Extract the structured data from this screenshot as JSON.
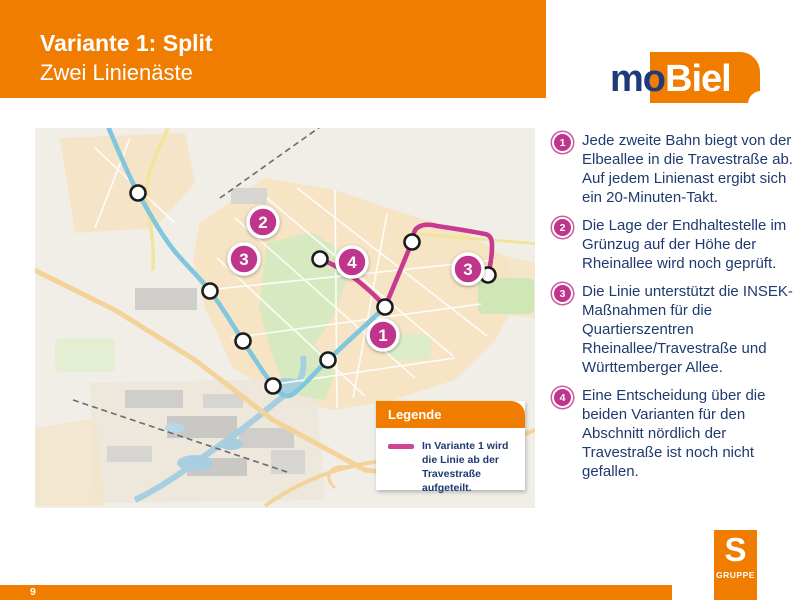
{
  "header": {
    "title": "Variante 1: Split",
    "subtitle": "Zwei Linienäste"
  },
  "mobiel_logo": {
    "mo": "mo",
    "biel": "Biel"
  },
  "notes": [
    {
      "num": "1",
      "text": "Jede zweite Bahn biegt von der Elbeallee in die Travestraße ab. Auf jedem Linienast ergibt sich ein 20-Minuten-Takt."
    },
    {
      "num": "2",
      "text": "Die Lage der Endhaltestelle im Grünzug auf der Höhe der Rheinallee wird noch geprüft."
    },
    {
      "num": "3",
      "text": "Die Linie unterstützt die INSEK-Maßnahmen für die Quartierszentren Rheinallee/Travestraße und Württemberger Allee."
    },
    {
      "num": "4",
      "text": "Eine Entscheidung über die beiden Varianten für den Abschnitt nördlich der Travestraße ist noch nicht gefallen."
    }
  ],
  "legend": {
    "title": "Legende",
    "entry": "In Variante 1 wird die Linie ab der Travestraße aufgeteilt."
  },
  "map": {
    "routes": {
      "blue": "M72,-4 C83,22 94,49 103,65 C116,88 129,111 142,126 C153,139 164,149 175,163 C188,180 197,196 208,213 C217,227 228,244 236,255 C242,263 250,272 258,266 C270,257 280,244 293,232 C311,215 332,196 350,179",
      "pink_west": "M285,131 C298,136 312,144 323,153 C334,162 344,171 350,179",
      "pink_loop": "M350,179 C357,162 368,136 377,114 C379,108 378,103 382,100 C387,96 394,96 402,98 C422,101 440,104 450,106 C456,107 457,112 457,118 C457,129 455,139 453,147"
    },
    "stops": [
      {
        "x": 103,
        "y": 65
      },
      {
        "x": 175,
        "y": 163
      },
      {
        "x": 208,
        "y": 213
      },
      {
        "x": 238,
        "y": 258
      },
      {
        "x": 293,
        "y": 232
      },
      {
        "x": 350,
        "y": 179
      },
      {
        "x": 285,
        "y": 131
      },
      {
        "x": 377,
        "y": 114
      },
      {
        "x": 453,
        "y": 147
      }
    ],
    "markers": [
      {
        "label": "2",
        "x": 228,
        "y": 94
      },
      {
        "label": "3",
        "x": 209,
        "y": 131
      },
      {
        "label": "4",
        "x": 317,
        "y": 134
      },
      {
        "label": "3",
        "x": 433,
        "y": 141
      },
      {
        "label": "1",
        "x": 348,
        "y": 207
      }
    ]
  },
  "footer": {
    "page": "9",
    "group_label": "GRUPPE",
    "group_initial": "S"
  },
  "colors": {
    "orange": "#F07C00",
    "magenta": "#C0358C",
    "line_blue": "#7FC6DF",
    "navy_text": "#1E3A6E"
  }
}
